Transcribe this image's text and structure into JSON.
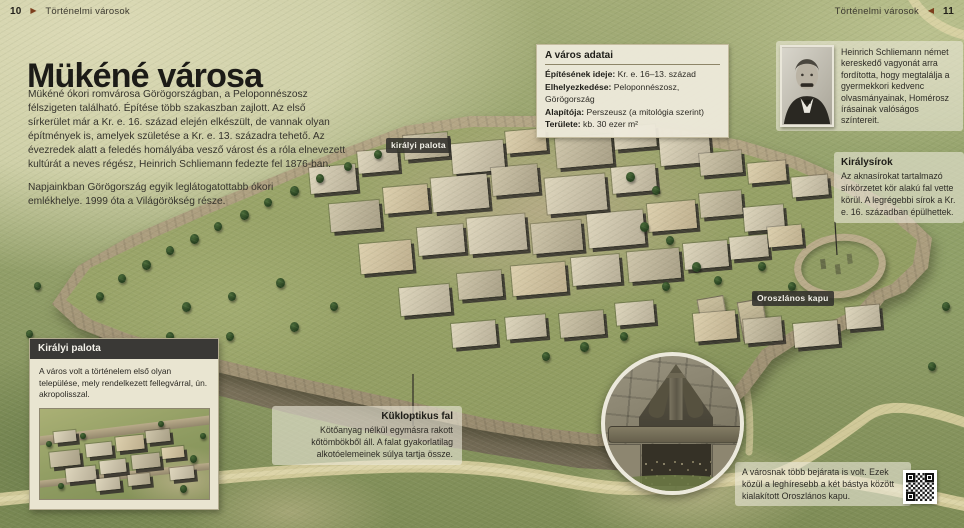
{
  "page": {
    "header_left": {
      "page_num": "10",
      "section": "Történelmi városok"
    },
    "header_right": {
      "page_num": "11",
      "section": "Történelmi városok"
    },
    "title": "Mükéné városa",
    "intro_p1": "Mükéné ókori romvárosa Görögországban, a Peloponnészosz félszigeten található. Építése több szakaszban zajlott. Az első sírkerület már a Kr. e. 16. század elején elkészült, de vannak olyan építmények is, amelyek születése a Kr. e. 13. századra tehető. Az évezredek alatt a feledés homályába vesző várost és a róla elnevezett kultúrát a neves régész, Heinrich Schliemann fedezte fel 1876-ban.",
    "intro_p2": "Napjainkban Görögország egyik leglátogatottabb ókori emlékhelye. 1999 óta a Világörökség része."
  },
  "icons": {
    "arrow_right": "▶",
    "arrow_left": "◀"
  },
  "facts_box": {
    "title": "A város adatai",
    "rows": [
      {
        "label": "Építésének ideje:",
        "value": "Kr. e. 16–13. század"
      },
      {
        "label": "Elhelyezkedése:",
        "value": "Peloponnészosz, Görögország"
      },
      {
        "label": "Alapítója:",
        "value": "Perszeusz (a mitológia szerint)"
      },
      {
        "label": "Területe:",
        "value": "kb. 30 ezer m²"
      }
    ]
  },
  "schliemann": {
    "text": "Heinrich Schliemann német kereskedő vagyonát arra fordította, hogy megtalálja a gyermekkori kedvenc olvasmányainak, Homérosz írásainak valóságos színtereit."
  },
  "royal_tombs": {
    "title": "Királysírok",
    "text": "Az aknasírokat tartalmazó sírkörzetet kör alakú fal vette körül. A legrégebbi sírok a Kr. e. 16. században épülhettek."
  },
  "labels": {
    "palace": "királyi palota",
    "lion_gate": "Oroszlános kapu"
  },
  "palace_box": {
    "title": "Királyi palota",
    "text": "A város volt a történelem első olyan települése, mely rendelkezett fellegvárral, ún. akropolisszal."
  },
  "cyclopean_wall": {
    "title": "Kükloptikus fal",
    "text": "Kötőanyag nélkül egymásra rakott kőtömbökből áll. A falat gyakorlatilag alkotóelemeinek súlya tartja össze."
  },
  "entrances_note": {
    "text": "A városnak több bejárata is volt. Ezek közül a leghíresebb a két bástya között kialakított Oroszlános kapu."
  },
  "colors": {
    "accent_brown": "#7c3e1d",
    "label_bg": "#30302b",
    "box_bg": "#eeeadb",
    "terrain_green": "#93a06a",
    "stone": "#a89a7b"
  }
}
